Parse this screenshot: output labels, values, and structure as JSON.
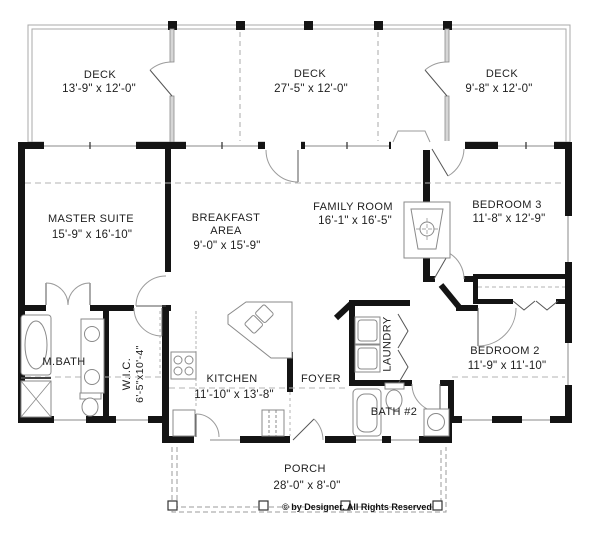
{
  "canvas": {
    "width": 600,
    "height": 537,
    "background": "#ffffff",
    "wall_color": "#141414",
    "line_color": "#9b9b9b",
    "text_color": "#1e1e1e"
  },
  "rooms": {
    "deck_left": {
      "label": "DECK",
      "dims": "13'-9\" x 12'-0\""
    },
    "deck_middle": {
      "label": "DECK",
      "dims": "27'-5\" x 12'-0\""
    },
    "deck_right": {
      "label": "DECK",
      "dims": "9'-8\" x 12'-0\""
    },
    "master_suite": {
      "label": "MASTER SUITE",
      "dims": "15'-9\" x 16'-10\""
    },
    "breakfast_area": {
      "label": "BREAKFAST",
      "label2": "AREA",
      "dims": "9'-0\" x 15'-9\""
    },
    "family_room": {
      "label": "FAMILY ROOM",
      "dims": "16'-1\" x 16'-5\""
    },
    "bedroom_3": {
      "label": "BEDROOM 3",
      "dims": "11'-8\" x 12'-9\""
    },
    "kitchen": {
      "label": "KITCHEN",
      "dims": "11'-10\" x 13'-8\""
    },
    "foyer": {
      "label": "FOYER"
    },
    "laundry": {
      "label": "LAUNDRY"
    },
    "wic": {
      "label": "W.I.C.",
      "dims": "6'-5\"x10'-4\""
    },
    "master_bath": {
      "label": "M.BATH"
    },
    "bath_2": {
      "label": "BATH #2"
    },
    "bedroom_2": {
      "label": "BEDROOM 2",
      "dims": "11'-9\" x 11'-10\""
    },
    "porch": {
      "label": "PORCH",
      "dims": "28'-0\" x 8'-0\""
    }
  },
  "footer": {
    "copyright": "© by Designer. All Rights Reserved"
  }
}
